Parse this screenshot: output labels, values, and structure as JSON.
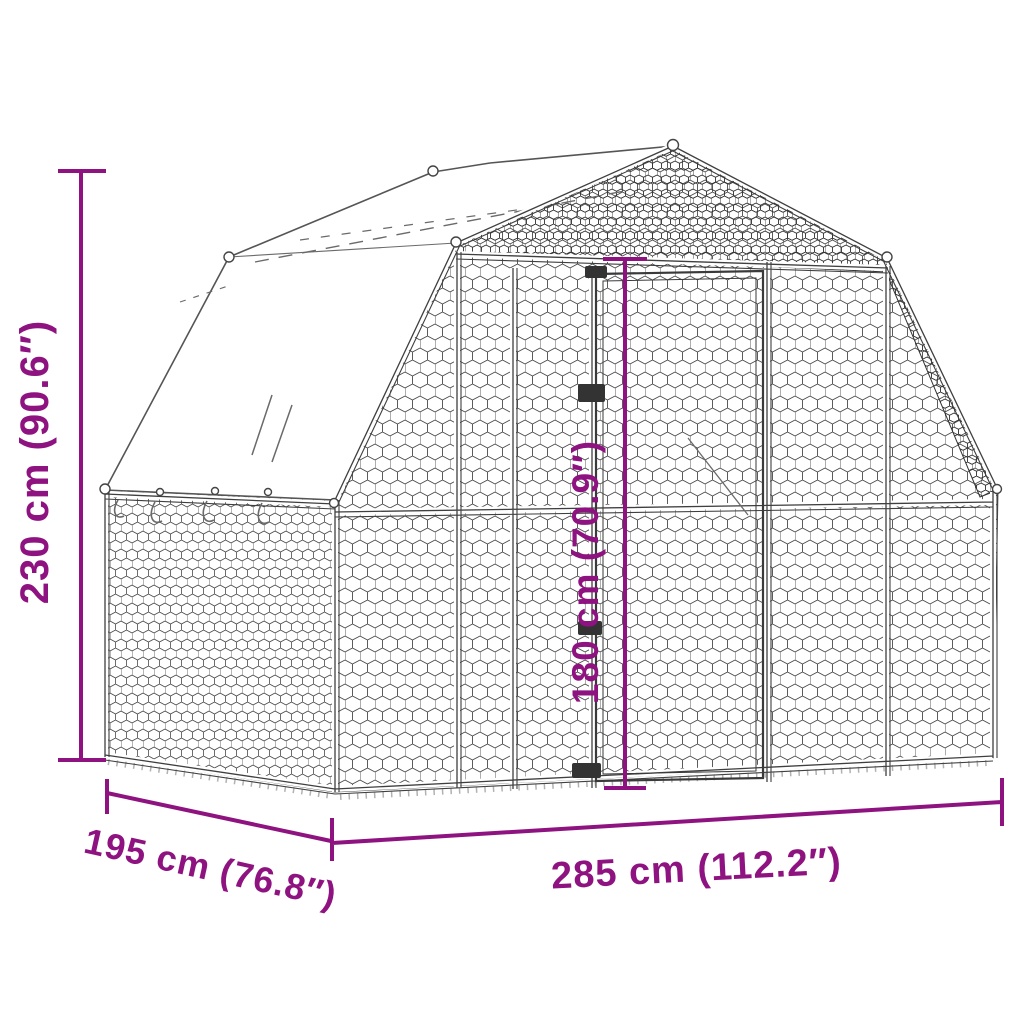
{
  "diagram": {
    "colors": {
      "dimension_annotation": "#8E1380",
      "line_art": "#3F3F3F",
      "cover_fill": "#FFFFFF",
      "background": "#FFFFFF"
    },
    "dimensions": {
      "total_height": "230 cm (90.6″)",
      "inner_height": "180 cm (70.9″)",
      "depth": "195 cm (76.8″)",
      "width": "285 cm (112.2″)"
    }
  }
}
